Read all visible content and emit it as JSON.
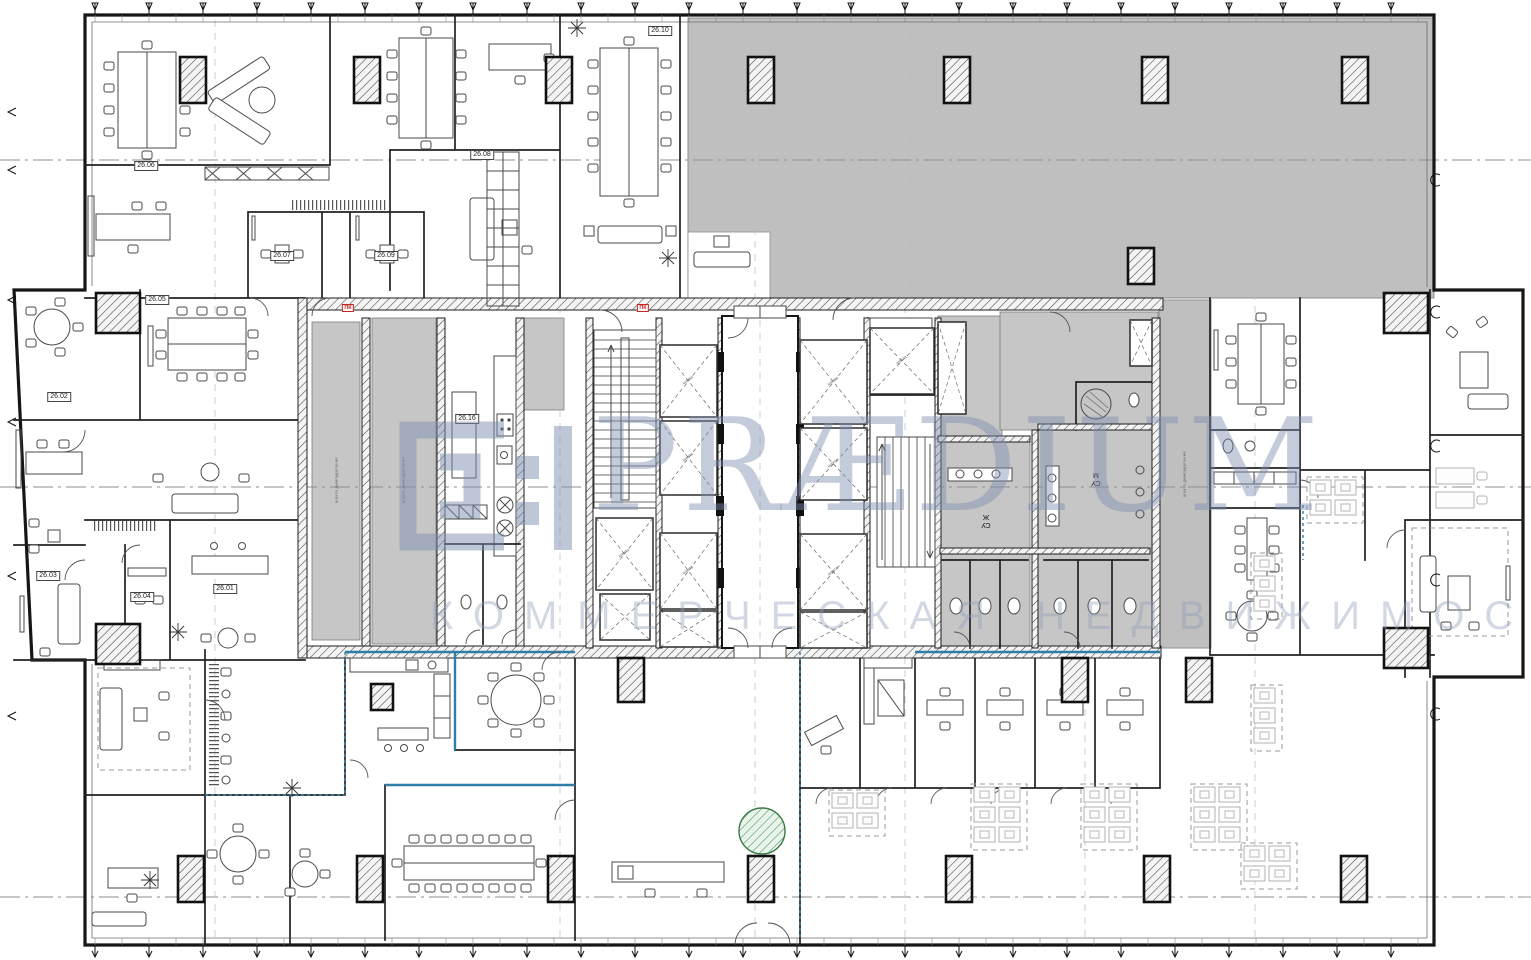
{
  "watermark": {
    "brand": "PRÆDIUM",
    "tagline": "КОММЕРЧЕСКАЯ НЕДВИЖИМОСТЬ",
    "color": "#7c8fb1"
  },
  "labels": {
    "rooms": [
      {
        "text": "26.10",
        "x": 660,
        "y": 31
      },
      {
        "text": "26.06",
        "x": 146,
        "y": 166
      },
      {
        "text": "26.08",
        "x": 482,
        "y": 155
      },
      {
        "text": "26.07",
        "x": 282,
        "y": 256
      },
      {
        "text": "26.09",
        "x": 386,
        "y": 256
      },
      {
        "text": "26.05",
        "x": 157,
        "y": 300
      },
      {
        "text": "26.02",
        "x": 59,
        "y": 397
      },
      {
        "text": "26.03",
        "x": 48,
        "y": 576
      },
      {
        "text": "26.04",
        "x": 142,
        "y": 597
      },
      {
        "text": "26.01",
        "x": 225,
        "y": 589
      },
      {
        "text": "26.16",
        "x": 467,
        "y": 419
      }
    ],
    "fire": {
      "text": "ПК",
      "positions": [
        [
          348,
          308
        ],
        [
          643,
          308
        ]
      ]
    },
    "shaft": {
      "text": "шахта"
    },
    "wc": [
      {
        "text": "СУ\nЖ",
        "x": 986,
        "y": 520
      },
      {
        "text": "СУ\nМ",
        "x": 1096,
        "y": 478
      }
    ],
    "risers": {
      "text": "шахта дымоудаления",
      "positions": [
        [
          336,
          480
        ],
        [
          403,
          480
        ],
        [
          1184,
          474
        ]
      ]
    }
  },
  "colors": {
    "wall": "#161616",
    "gray_zone": "#bfbfbf",
    "teal_wall": "#2d7fa8",
    "watermark": "#7c8fb1",
    "fire_red": "#cc2222",
    "tree_green": "#4f9e5f"
  },
  "structure": {
    "columns": [
      [
        180,
        57,
        26,
        46
      ],
      [
        354,
        57,
        26,
        46
      ],
      [
        546,
        57,
        26,
        46
      ],
      [
        748,
        57,
        26,
        46
      ],
      [
        944,
        57,
        26,
        46
      ],
      [
        1142,
        57,
        26,
        46
      ],
      [
        1342,
        57,
        26,
        46
      ],
      [
        178,
        856,
        26,
        46
      ],
      [
        357,
        856,
        26,
        46
      ],
      [
        548,
        856,
        26,
        46
      ],
      [
        748,
        856,
        26,
        46
      ],
      [
        946,
        856,
        26,
        46
      ],
      [
        1144,
        856,
        26,
        46
      ],
      [
        1341,
        856,
        26,
        46
      ],
      [
        96,
        293,
        44,
        40
      ],
      [
        96,
        624,
        44,
        40
      ],
      [
        1384,
        293,
        44,
        40
      ],
      [
        1384,
        628,
        44,
        40
      ],
      [
        618,
        658,
        26,
        44
      ],
      [
        1062,
        658,
        26,
        44
      ],
      [
        1186,
        658,
        26,
        44
      ],
      [
        371,
        684,
        22,
        26
      ],
      [
        1128,
        248,
        26,
        36
      ]
    ],
    "shafts": [
      [
        660,
        345,
        57,
        72
      ],
      [
        660,
        421,
        57,
        74
      ],
      [
        660,
        533,
        57,
        76
      ],
      [
        660,
        611,
        57,
        36
      ],
      [
        800,
        340,
        67,
        84
      ],
      [
        800,
        428,
        67,
        72
      ],
      [
        800,
        534,
        67,
        76
      ],
      [
        800,
        612,
        67,
        36
      ],
      [
        596,
        518,
        57,
        72
      ],
      [
        600,
        594,
        50,
        46
      ],
      [
        870,
        328,
        64,
        66
      ],
      [
        938,
        322,
        28,
        92
      ],
      [
        1130,
        320,
        22,
        46
      ]
    ],
    "clusters": [
      [
        832,
        793,
        2,
        2
      ],
      [
        974,
        787,
        2,
        3
      ],
      [
        1084,
        787,
        2,
        3
      ],
      [
        1194,
        787,
        2,
        3
      ],
      [
        1254,
        556,
        1,
        3
      ],
      [
        1254,
        688,
        1,
        3
      ],
      [
        1244,
        846,
        2,
        2
      ],
      [
        1310,
        480,
        2,
        2
      ]
    ],
    "plants": [
      [
        577,
        28
      ],
      [
        668,
        258
      ],
      [
        178,
        632
      ],
      [
        292,
        788
      ],
      [
        150,
        880
      ]
    ],
    "tree": [
      762,
      831,
      23
    ],
    "ticks": {
      "top": {
        "x0": 95,
        "x1": 1391,
        "step": 54,
        "y": 15
      },
      "bottom": {
        "x0": 95,
        "x1": 1429,
        "step": 54,
        "y": 945
      },
      "left_y": [
        112,
        170,
        300,
        422,
        576,
        716
      ],
      "right_y": [
        180,
        312,
        446,
        580,
        714
      ]
    },
    "grid_x": [
      215,
      560,
      755,
      905,
      1085,
      1255
    ],
    "axis_y": [
      160,
      487,
      897
    ]
  }
}
